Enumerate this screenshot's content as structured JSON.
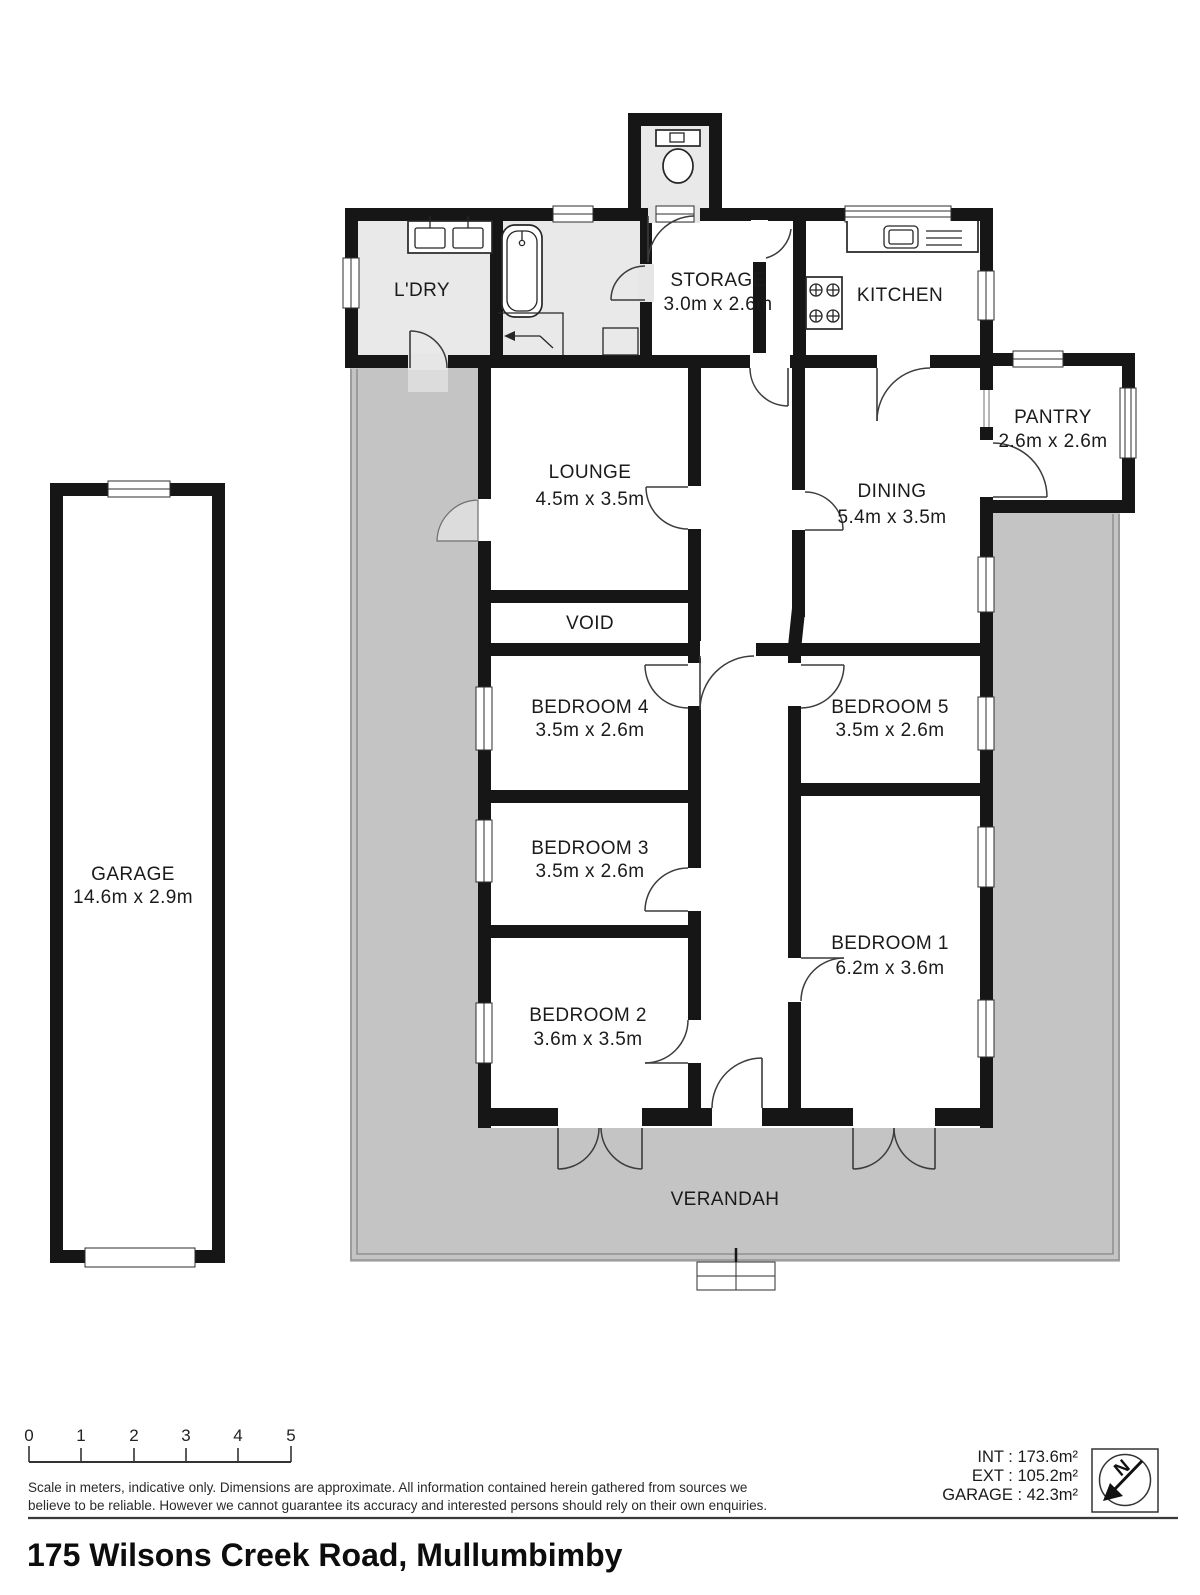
{
  "title": "175 Wilsons Creek Road, Mullumbimby",
  "rooms": {
    "ldry": {
      "name": "L'DRY"
    },
    "storage": {
      "name": "STORAGE",
      "dims": "3.0m x 2.6m"
    },
    "kitchen": {
      "name": "KITCHEN"
    },
    "pantry": {
      "name": "PANTRY",
      "dims": "2.6m x 2.6m"
    },
    "lounge": {
      "name": "LOUNGE",
      "dims": "4.5m x 3.5m"
    },
    "dining": {
      "name": "DINING",
      "dims": "5.4m x 3.5m"
    },
    "void": {
      "name": "VOID"
    },
    "bedroom4": {
      "name": "BEDROOM 4",
      "dims": "3.5m x 2.6m"
    },
    "bedroom5": {
      "name": "BEDROOM 5",
      "dims": "3.5m x 2.6m"
    },
    "bedroom3": {
      "name": "BEDROOM 3",
      "dims": "3.5m x 2.6m"
    },
    "bedroom2": {
      "name": "BEDROOM 2",
      "dims": "3.6m x 3.5m"
    },
    "bedroom1": {
      "name": "BEDROOM 1",
      "dims": "6.2m x 3.6m"
    },
    "verandah": {
      "name": "VERANDAH"
    },
    "garage": {
      "name": "GARAGE",
      "dims": "14.6m x 2.9m"
    }
  },
  "scale_bar": {
    "labels": [
      "0",
      "1",
      "2",
      "3",
      "4",
      "5"
    ]
  },
  "disclaimer": {
    "line1": "Scale in meters, indicative only. Dimensions are approximate. All information contained herein gathered from sources we",
    "line2": "believe to be reliable. However we cannot guarantee its accuracy and interested persons should rely on their own enquiries."
  },
  "areas": {
    "int": "INT : 173.6m²",
    "ext": "EXT : 105.2m²",
    "garage": "GARAGE : 42.3m²"
  },
  "compass": {
    "north_label": "N"
  },
  "colors": {
    "wall": "#161616",
    "verandah": "#c4c4c4",
    "wet_area": "#e9e9e9"
  }
}
